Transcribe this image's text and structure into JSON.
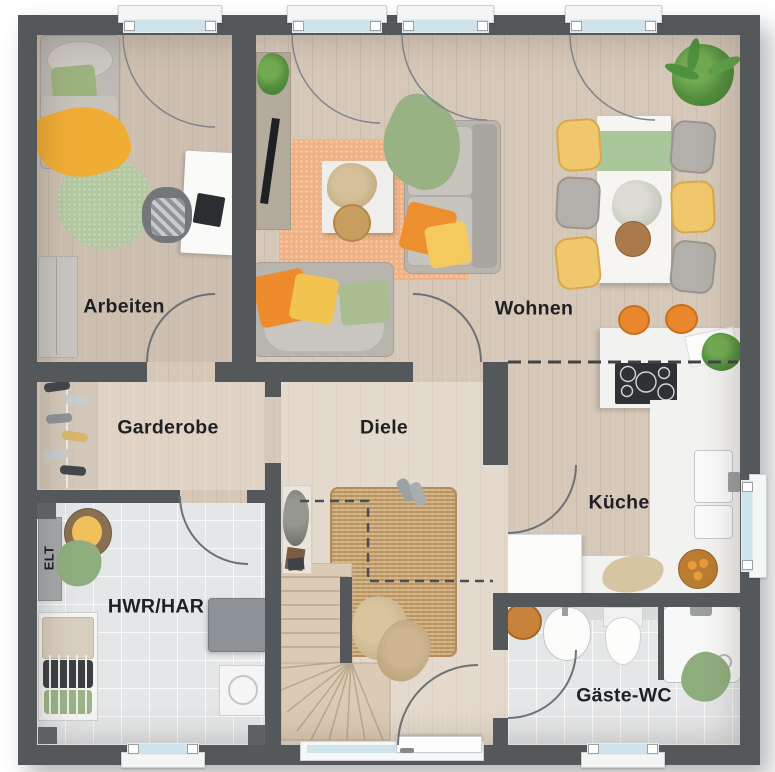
{
  "plan": {
    "room_labels": {
      "arbeiten": "Arbeiten",
      "wohnen": "Wohnen",
      "garderobe": "Garderobe",
      "diele": "Diele",
      "kueche": "Küche",
      "hwr": "HWR/HAR",
      "elt": "ELT",
      "gaeste_wc": "Gäste-WC"
    },
    "colors": {
      "wall": "#54585b",
      "floor_wood": "#d5c8b9",
      "floor_tile": "#e4e6e8",
      "window_glass": "#cfe3ec",
      "rug_orange": "#f0b183",
      "rug_green": "#b3c7a0",
      "rug_jute": "#c7a26f",
      "accent_orange": "#ee8c2d",
      "accent_yellow": "#f2c44f",
      "accent_green": "#98b284",
      "counter_white": "#f2f2f0",
      "stove_black": "#2e3235"
    }
  }
}
